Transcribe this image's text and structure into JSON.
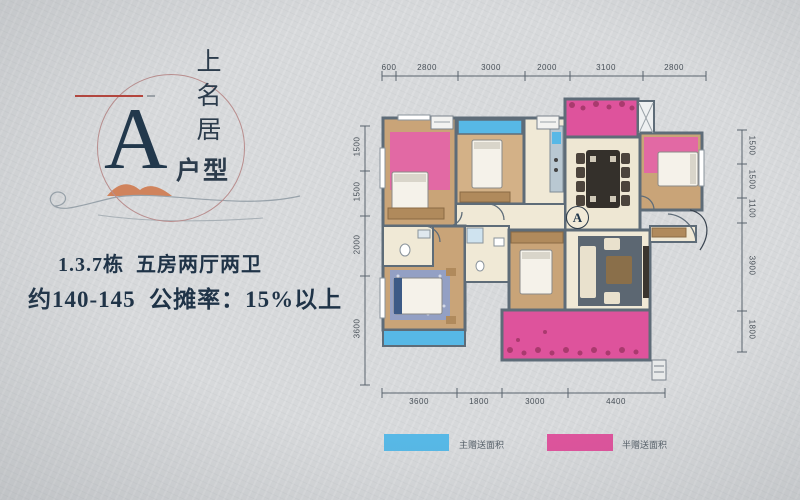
{
  "logo": {
    "letter": "A",
    "brand_chars": [
      "上",
      "名",
      "居"
    ],
    "unit_label": "户型"
  },
  "headline": {
    "line1": "1.3.7栋  五房两厅两卫",
    "line2": "约140-145  公摊率：15%以上"
  },
  "floorplan": {
    "marker": "A",
    "dims": {
      "top": [
        "600",
        "2800",
        "3000",
        "2000",
        "3100",
        "2800"
      ],
      "bottom": [
        "3600",
        "1800",
        "3000",
        "4400"
      ],
      "left": [
        "1500",
        "1500",
        "2000",
        "3600"
      ],
      "right": [
        "1500",
        "1500",
        "1100",
        "3900",
        "1800"
      ]
    }
  },
  "legend": {
    "items": [
      {
        "label": "主赠送面积",
        "color": "#57b8e6"
      },
      {
        "label": "半赠送面积",
        "color": "#de539c"
      }
    ]
  },
  "colors": {
    "accent_pink": "#de539c",
    "accent_blue": "#57b8e6",
    "wall": "#5e6c78",
    "wood_floor": "#c9a478",
    "cream_floor": "#f0e9d6",
    "text_navy": "#1f3347",
    "logo_circle": "#b98e8e",
    "red_line": "#b5443c"
  }
}
